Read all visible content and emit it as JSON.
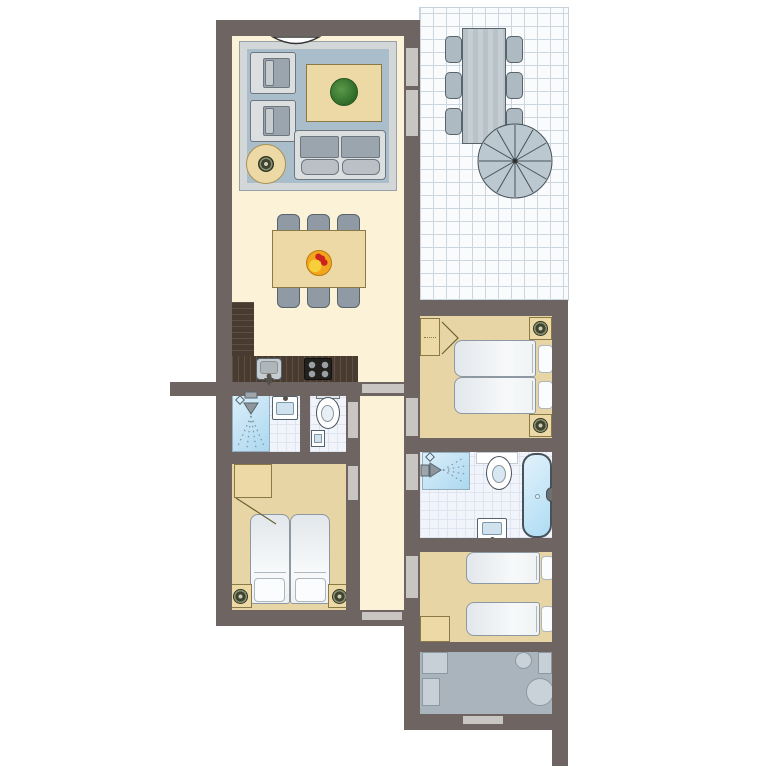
{
  "title": "Holiday apartment floor plan",
  "palette": {
    "wall": "#6E6461",
    "floor_cream": "#FBF2D8",
    "floor_tan": "#E7D5A5",
    "tile_floor": "#F1F4FA",
    "terrace_floor": "#F9FBFD",
    "rug_blue": "#A9BDCB",
    "wood": "#ECD9A6",
    "kitchen_counter": "#4A3B30",
    "furniture_gray": "#8F9AA4",
    "water_blue": "#ACD8EF",
    "utility_gray": "#A9B4BC",
    "door_opening": "#C8C5C3",
    "plant_green": "#3E7D32",
    "fruit_orange": "#F2A61C"
  },
  "rooms": [
    {
      "id": "living-room",
      "label": "Living room",
      "furniture": [
        "rug",
        "sofa",
        "armchair",
        "armchair",
        "coffee table with plant",
        "round side table with lamp"
      ]
    },
    {
      "id": "dining-area",
      "label": "Dining area",
      "furniture": [
        "dining table",
        "6 chairs",
        "fruit bowl"
      ]
    },
    {
      "id": "kitchen",
      "label": "Kitchen",
      "furniture": [
        "L-shaped counter",
        "sink",
        "4-burner hob"
      ]
    },
    {
      "id": "terrace",
      "label": "Terrace",
      "furniture": [
        "outdoor dining table",
        "6 outdoor chairs",
        "spiral staircase"
      ]
    },
    {
      "id": "shower-room",
      "label": "Shower room",
      "furniture": [
        "shower",
        "washbasin"
      ]
    },
    {
      "id": "toilet-room",
      "label": "Toilet",
      "furniture": [
        "toilet",
        "hand basin"
      ]
    },
    {
      "id": "bedroom-1",
      "label": "Bedroom 1 (double)",
      "furniture": [
        "double bed",
        "wardrobe",
        "2 nightstands with lamps"
      ]
    },
    {
      "id": "bedroom-2",
      "label": "Bedroom 2 (double)",
      "furniture": [
        "double bed",
        "wardrobe",
        "2 nightstands with lamps"
      ]
    },
    {
      "id": "bedroom-3",
      "label": "Bedroom 3 (twin)",
      "furniture": [
        "single bed",
        "single bed",
        "wardrobe"
      ]
    },
    {
      "id": "bathroom",
      "label": "Bathroom",
      "furniture": [
        "shower",
        "toilet",
        "bathtub",
        "washbasin"
      ]
    },
    {
      "id": "hallway",
      "label": "Hallway",
      "furniture": []
    },
    {
      "id": "utility-room",
      "label": "Utility room",
      "furniture": [
        "counter appliances",
        "washing machine",
        "boiler"
      ]
    }
  ],
  "doors": [
    "entrance door (top, with swing)",
    "living room to terrace (2 openings)",
    "dining to hallway",
    "toilet door",
    "bedroom-2 door",
    "bedroom-1 door",
    "bathroom door",
    "bedroom-3 door",
    "hallway south door",
    "utility room door"
  ]
}
